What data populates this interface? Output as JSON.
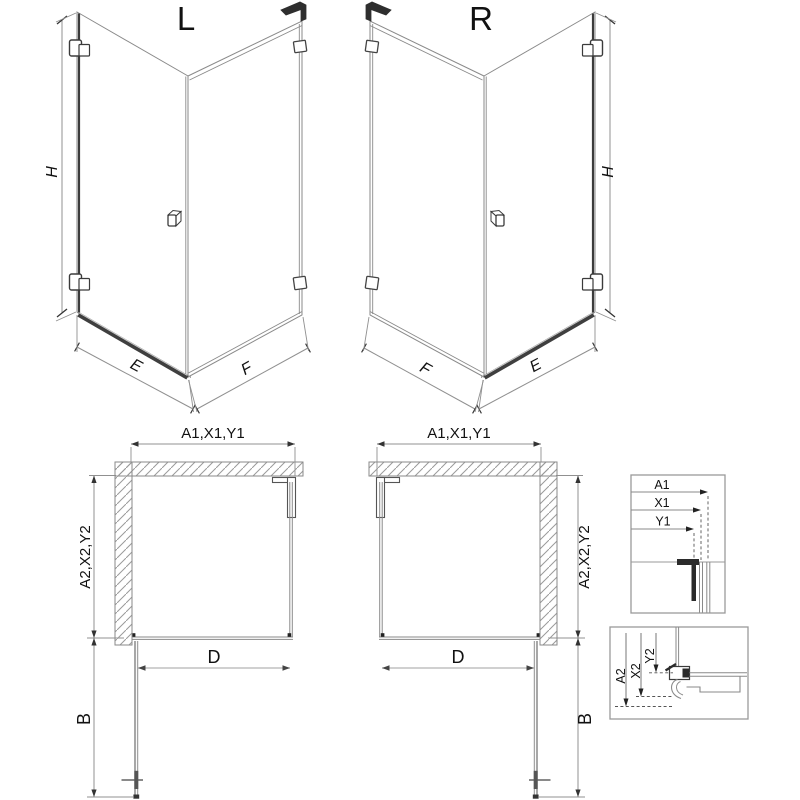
{
  "drawing": {
    "variant_left": {
      "title": "L",
      "height_label": "H",
      "door_edge_label": "E",
      "panel_edge_label": "F"
    },
    "variant_right": {
      "title": "R",
      "height_label": "H",
      "door_edge_label": "E",
      "panel_edge_label": "F"
    },
    "plan_left": {
      "width_label": "A1,X1,Y1",
      "depth_label": "A2,X2,Y2",
      "door_label": "D",
      "swing_label": "B"
    },
    "plan_right": {
      "width_label": "A1,X1,Y1",
      "depth_label": "A2,X2,Y2",
      "door_label": "D",
      "swing_label": "B"
    },
    "detail_top": {
      "a1": "A1",
      "x1": "X1",
      "y1": "Y1"
    },
    "detail_bottom": {
      "a2": "A2",
      "x2": "X2",
      "y2": "Y2"
    }
  },
  "colors": {
    "line": "#8a8a8a",
    "dark": "#2e2e2e",
    "text": "#111111",
    "background": "#ffffff"
  }
}
